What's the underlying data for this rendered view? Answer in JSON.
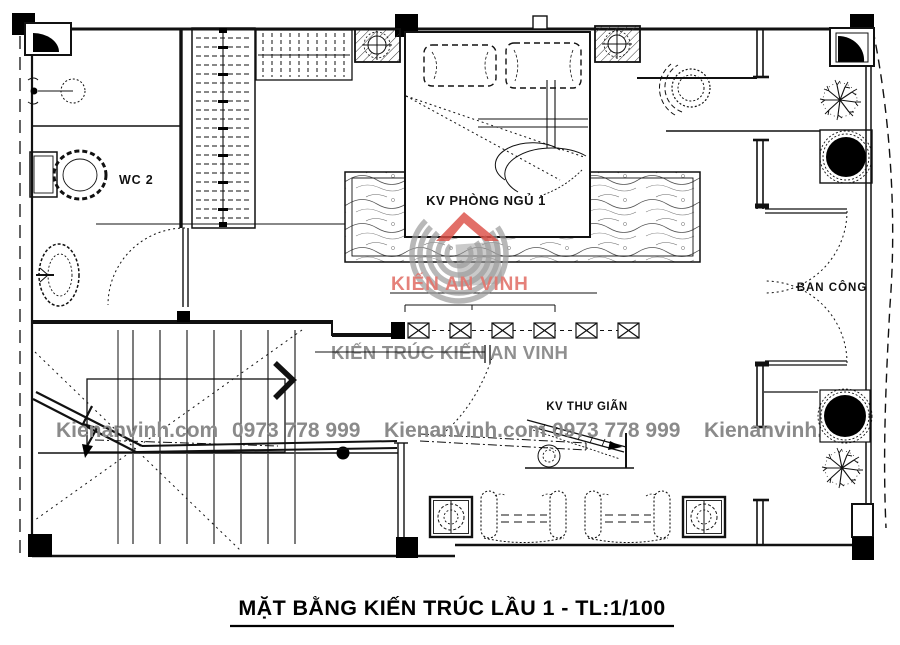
{
  "title": {
    "text": "MẶT BẰNG KIẾN TRÚC LẦU 1 - TL:1/100"
  },
  "rooms": {
    "wc_label": "WC 2",
    "bedroom_label": "KV PHÒNG NGỦ 1",
    "relax_label": "KV THƯ GIÃN",
    "balcony_label": "BAN CÔNG"
  },
  "watermarks": {
    "website": "Kienanvinh.com",
    "phone": "0973 778 999",
    "brand_line": "KIẾN TRÚC KIẾN AN VINH",
    "logo_text": "KIẾN AN VINH"
  },
  "colors": {
    "line": "#111111",
    "watermark_gray": "#8a8a8a",
    "brand_gray": "#8f8f8f",
    "logo_red": "#dc4f47",
    "logo_text_red": "#e2736c"
  }
}
